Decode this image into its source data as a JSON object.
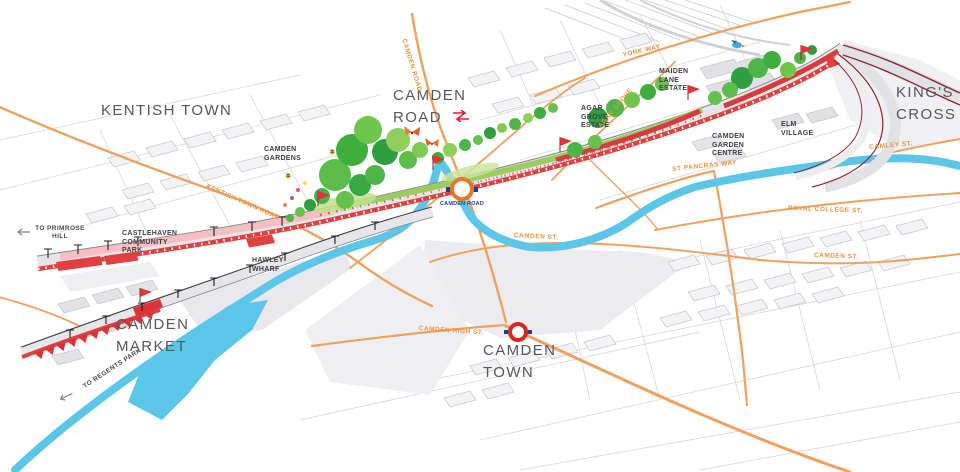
{
  "map": {
    "district_labels": {
      "kentish_town": "KENTISH TOWN",
      "camden_road": "CAMDEN ROAD",
      "kings_cross": "KING'S CROSS",
      "camden_market": "CAMDEN MARKET",
      "camden_town": "CAMDEN TOWN"
    },
    "place_labels": {
      "camden_gardens": "CAMDEN GARDENS",
      "castlehaven": "CASTLEHAVEN COMMUNITY PARK",
      "hawley_wharf": "HAWLEY WHARF",
      "maiden_lane_estate": "MAIDEN LANE ESTATE",
      "agar_grove_estate": "AGAR GROVE ESTATE",
      "camden_garden_centre": "CAMDEN GARDEN CENTRE",
      "elm_village": "ELM VILLAGE"
    },
    "street_labels": {
      "kentish_town_road": "KENTISH TOWN ROAD",
      "camden_road": "CAMDEN ROAD",
      "york_way": "YORK WAY",
      "agar_grove": "AGAR GROVE",
      "camley_st": "CAMLEY ST.",
      "st_pancras_way": "ST PANCRAS WAY",
      "royal_college_st": "ROYAL COLLEGE ST.",
      "camden_st_west": "CAMDEN ST.",
      "camden_st_east": "CAMDEN ST.",
      "camden_high_st": "CAMDEN HIGH ST."
    },
    "stations": {
      "camden_road_overground": "CAMDEN ROAD"
    },
    "directions": {
      "to_primrose_hill": "TO PRIMROSE HILL",
      "to_regents_park": "TO REGENTS PARK"
    },
    "icons": {
      "national_rail": "red double-arrow",
      "overground_roundel": "orange ring with blue bar",
      "underground_roundel": "red ring with blue bar",
      "flag": "red pennant",
      "bee": "bee",
      "butterfly": "orange butterfly",
      "bird": "blue kingfisher",
      "direction_arrow": "left arrow"
    },
    "colors": {
      "road_orange": "#F0A15F",
      "street_label_orange": "#E8923F",
      "canal_blue": "#5BC6E8",
      "viaduct_red": "#E04040",
      "route_pink": "#F6BDC2",
      "park_green": "#4CB648",
      "district_label_gray": "#56575B",
      "place_label_dark": "#3E3E40",
      "rail_maroon": "#8C2730",
      "roundel_blue": "#1C3F94",
      "overground_orange": "#E87722",
      "underground_red": "#DA291C",
      "national_rail_red": "#E21836"
    }
  }
}
